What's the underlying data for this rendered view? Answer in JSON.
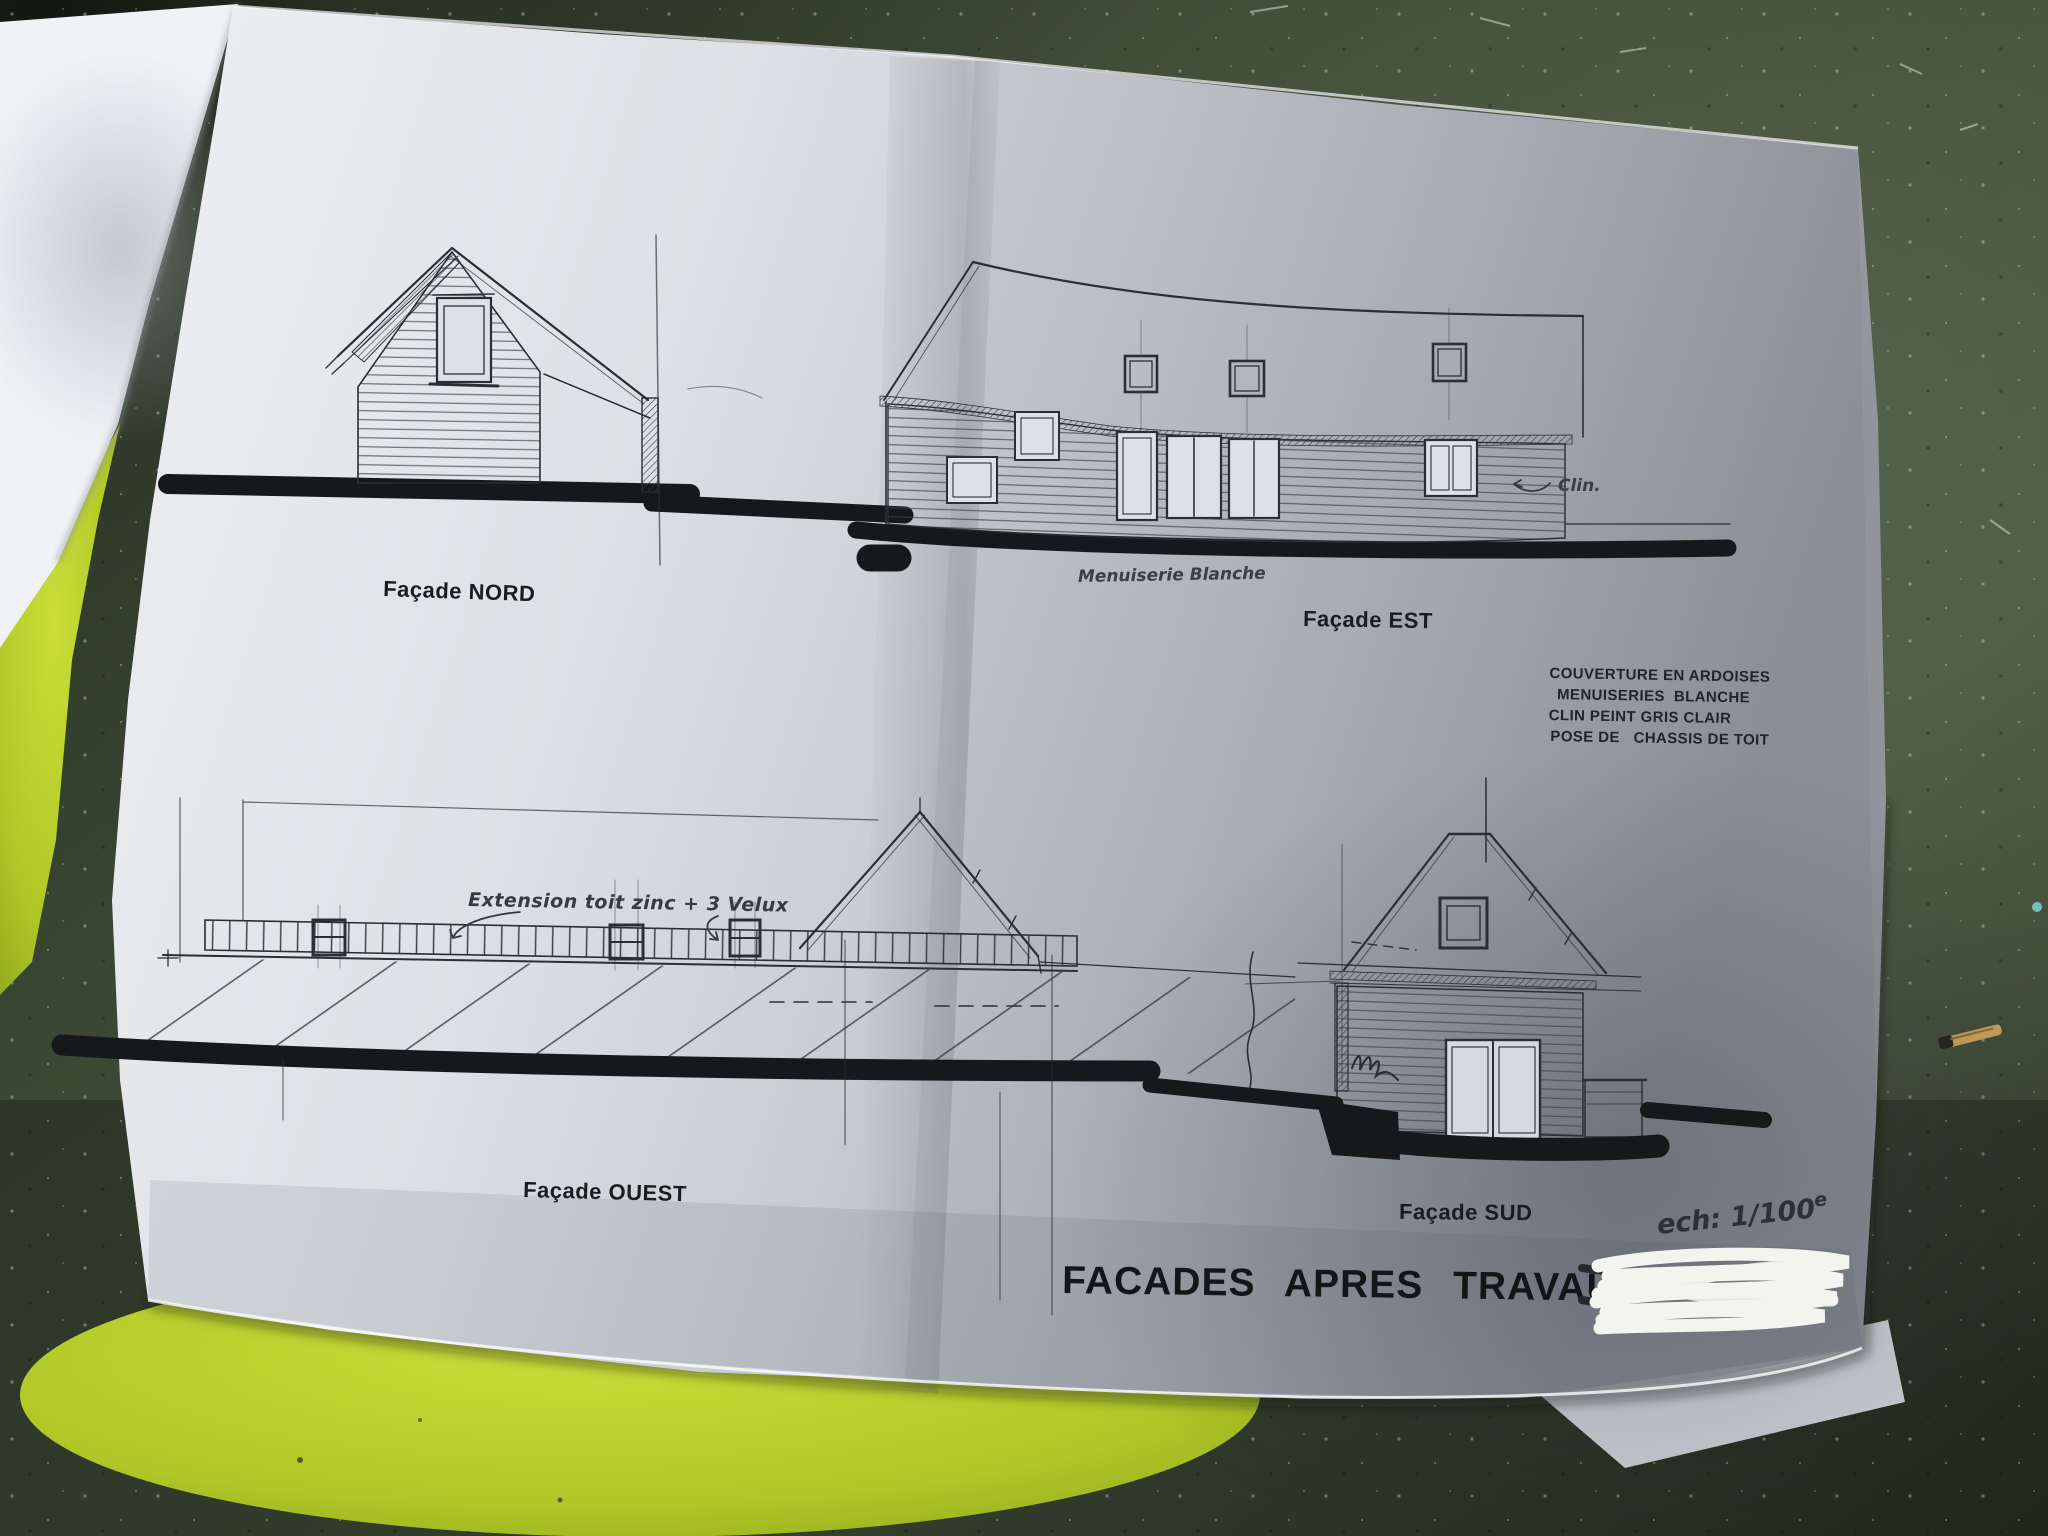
{
  "document": {
    "title": "FACADES APRES TRAVAUX",
    "facade_labels": {
      "nord": "Façade NORD",
      "est": "Façade EST",
      "ouest": "Façade OUEST",
      "sud": "Façade SUD"
    },
    "spec_notes": [
      "COUVERTURE EN ARDOISES",
      "MENUISERIES  BLANCHE",
      "CLIN PEINT GRIS CLAIR",
      "POSE DE   CHASSIS DE TOIT"
    ],
    "handwritten": {
      "menuiserie": "Menuiserie Blanche",
      "clin": "Clin.",
      "extension": "Extension toit zinc + 3 Velux",
      "scale_main": "ech: 1/100",
      "scale_sup": "e",
      "covered_partial": "gis"
    },
    "colors": {
      "ink": "#2b2e33",
      "paper_light": "#edeff2",
      "paper_dark": "#94989f",
      "table_green": "#3c4937",
      "stool_green": "#b5cc2e",
      "scribble_white": "#f3f4f0"
    }
  }
}
